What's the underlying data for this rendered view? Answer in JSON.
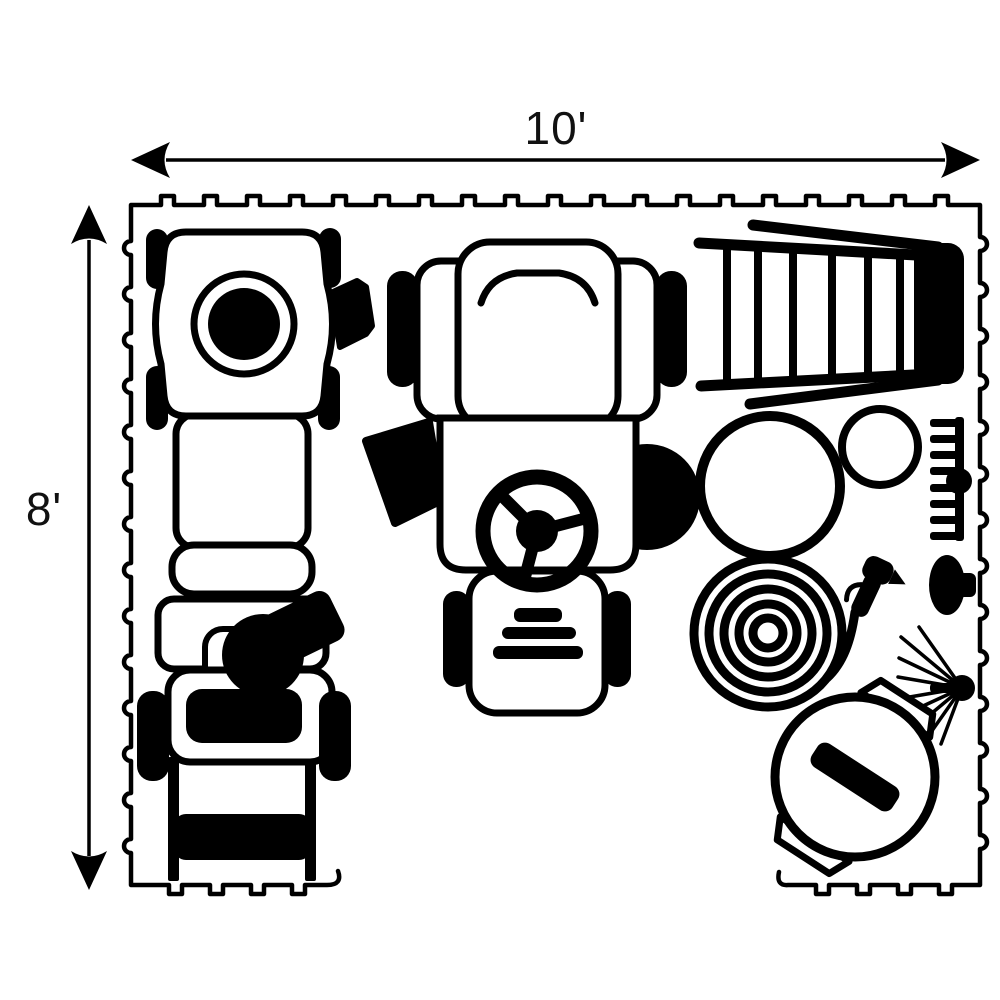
{
  "diagram": {
    "type": "floor-plan-top-view",
    "description": "10 ft by 8 ft interlocking floor tile mat shown with outdoor power equipment arranged on it",
    "colors": {
      "ink": "#000000",
      "background": "#ffffff"
    },
    "dimensions": {
      "width": {
        "label": "10'",
        "value_ft": 10
      },
      "height": {
        "label": "8'",
        "value_ft": 8
      }
    },
    "floor": {
      "edge_style": "interlocking-tile-tabs",
      "open_side": "bottom-center"
    },
    "items": [
      {
        "id": "push-mower",
        "name": "Push lawn mower (top view)"
      },
      {
        "id": "snow-blower",
        "name": "Snow blower (top view)"
      },
      {
        "id": "riding-mower",
        "name": "Riding lawn mower (top view)"
      },
      {
        "id": "ladder",
        "name": "Step ladder lying flat"
      },
      {
        "id": "large-lid",
        "name": "Large round can lid"
      },
      {
        "id": "small-lid",
        "name": "Small round can lid"
      },
      {
        "id": "garden-rake",
        "name": "Garden rake head"
      },
      {
        "id": "dustpan",
        "name": "Dust pan"
      },
      {
        "id": "garden-hose",
        "name": "Coiled garden hose"
      },
      {
        "id": "spray-nozzle",
        "name": "Hose spray nozzle"
      },
      {
        "id": "leaf-rake",
        "name": "Leaf rake fan"
      },
      {
        "id": "trash-can",
        "name": "Trash can with lid handle"
      }
    ]
  }
}
